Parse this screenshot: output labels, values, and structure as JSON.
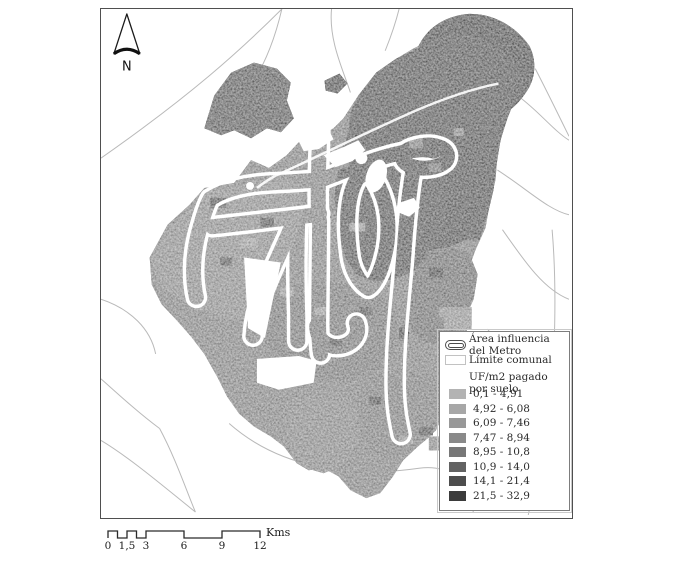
{
  "legend": {
    "area_metro_label": "Área influencia del Metro",
    "limite_comunal_label": "Límite comunal",
    "ramp_title": "UF/m2 pagado por suelo",
    "classes": [
      {
        "label": "0,1 - 4,91",
        "color": "#b3b3b3"
      },
      {
        "label": "4,92 - 6,08",
        "color": "#a7a7a7"
      },
      {
        "label": "6,09 - 7,46",
        "color": "#989898"
      },
      {
        "label": "7,47 - 8,94",
        "color": "#898989"
      },
      {
        "label": "8,95 - 10,8",
        "color": "#777777"
      },
      {
        "label": "10,9 - 14,0",
        "color": "#626262"
      },
      {
        "label": "14,1 - 21,4",
        "color": "#4d4d4d"
      },
      {
        "label": "21,5 - 32,9",
        "color": "#3b3b3b"
      }
    ]
  },
  "north_arrow": {
    "label": "N"
  },
  "scale_bar": {
    "tick_labels": [
      "0",
      "1,5",
      "3",
      "6",
      "9",
      "12"
    ],
    "unit_label": "Kms"
  }
}
